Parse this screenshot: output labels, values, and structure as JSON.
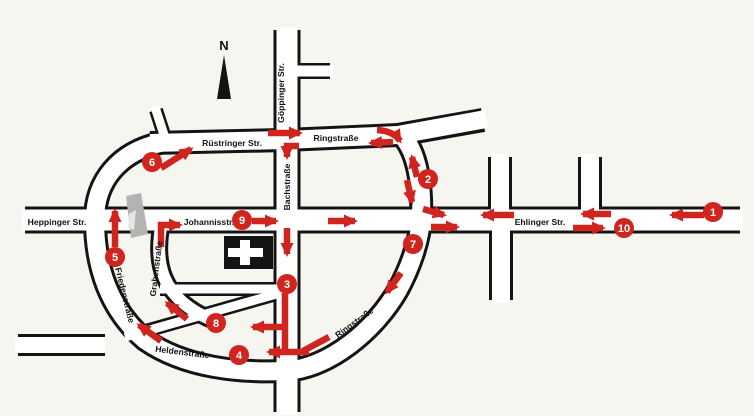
{
  "colors": {
    "background": "#f7f5ef",
    "road_casing": "#141414",
    "road_fill": "#ffffff",
    "accent_red": "#d0241f",
    "building_gray": "#b3b3b3",
    "text_black": "#111111"
  },
  "compass": {
    "label": "N"
  },
  "streets": {
    "heppinger": "Heppinger Str.",
    "ruestringer": "Rüstringer Str.",
    "goeppinger": "Göppinger Str.",
    "ringstrasse_top": "Ringstraße",
    "bachstrasse": "Bachstraße",
    "johannisstr": "Johannisstr.",
    "ehlinger": "Ehlinger Str.",
    "grabenstrasse": "Grabenstraße",
    "friedenstrasse": "Friedenstraße",
    "heldenstrasse": "Heldenstraße",
    "ringstrasse_bottom": "Ringstraße"
  },
  "route_stops": [
    "1",
    "2",
    "3",
    "4",
    "5",
    "6",
    "7",
    "8",
    "9",
    "10"
  ],
  "icons": {
    "hospital": "hospital-cross-icon",
    "compass": "north-arrow-icon"
  }
}
